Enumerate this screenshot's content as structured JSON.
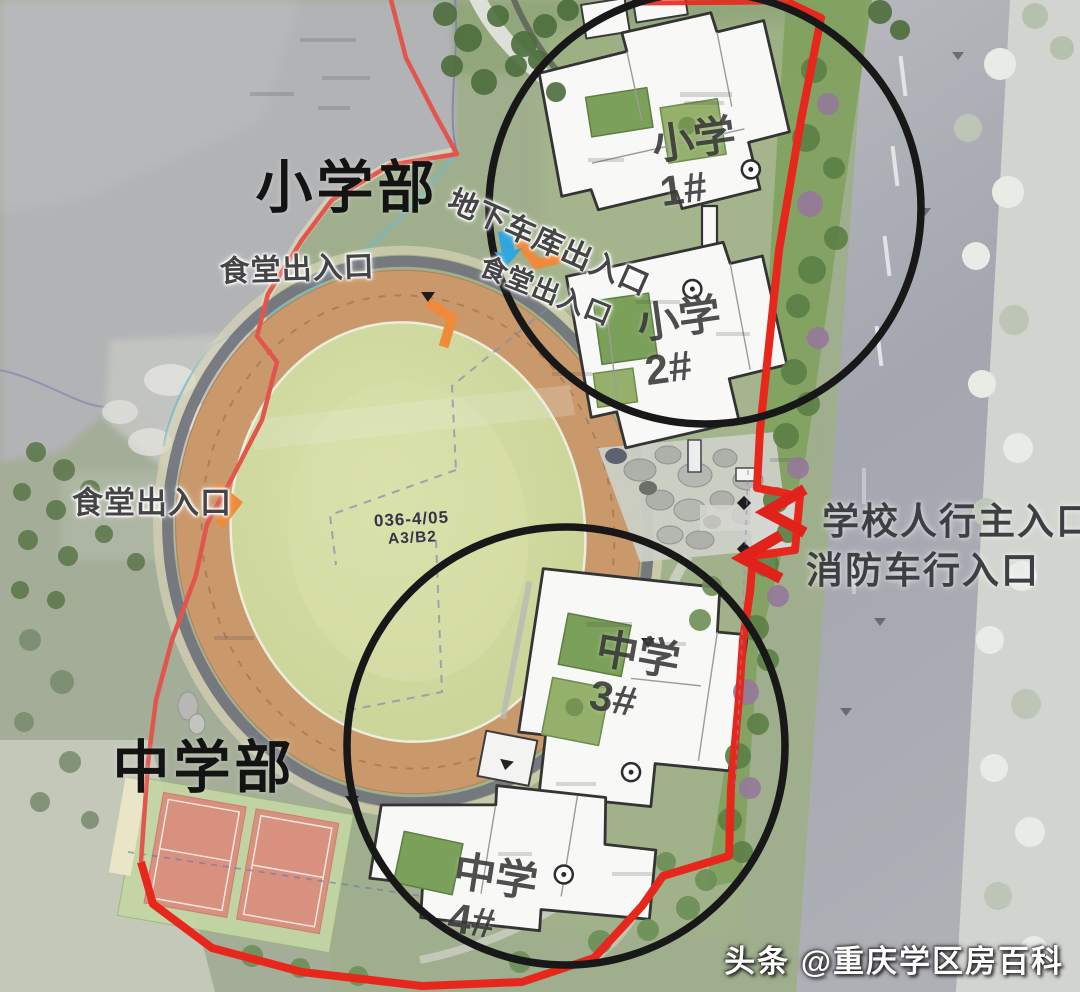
{
  "sections": {
    "primary": "小学部",
    "middle": "中学部"
  },
  "entrances": {
    "underground_garage": "地下车库出入口",
    "canteen_west": "食堂出入口",
    "canteen_inner": "食堂出入口",
    "canteen_southwest": "食堂出入口",
    "school_pedestrian_main": "学校人行主入口",
    "fire_truck": "消防车行入口"
  },
  "buildings": {
    "primary_1": {
      "name": "小学",
      "number": "1#"
    },
    "primary_2": {
      "name": "小学",
      "number": "2#"
    },
    "middle_3": {
      "name": "中学",
      "number": "3#"
    },
    "middle_4": {
      "name": "中学",
      "number": "4#"
    }
  },
  "plot_code": {
    "line1": "036-4/05",
    "line2": "A3/B2"
  },
  "watermark": {
    "source": "头条",
    "account": "@重庆学区房百科"
  },
  "colors": {
    "boundary_red": "#e7271c",
    "highlight_circle_black": "#181818",
    "track_tan": "#c9996c",
    "infield_green": "#cdd89c",
    "arrow_orange": "#ef8a3a",
    "arrow_blue": "#2fa6de",
    "court_salmon": "#d8917f",
    "lake_gray": "#b1b3b5",
    "road_gray": "#a9abb3"
  }
}
